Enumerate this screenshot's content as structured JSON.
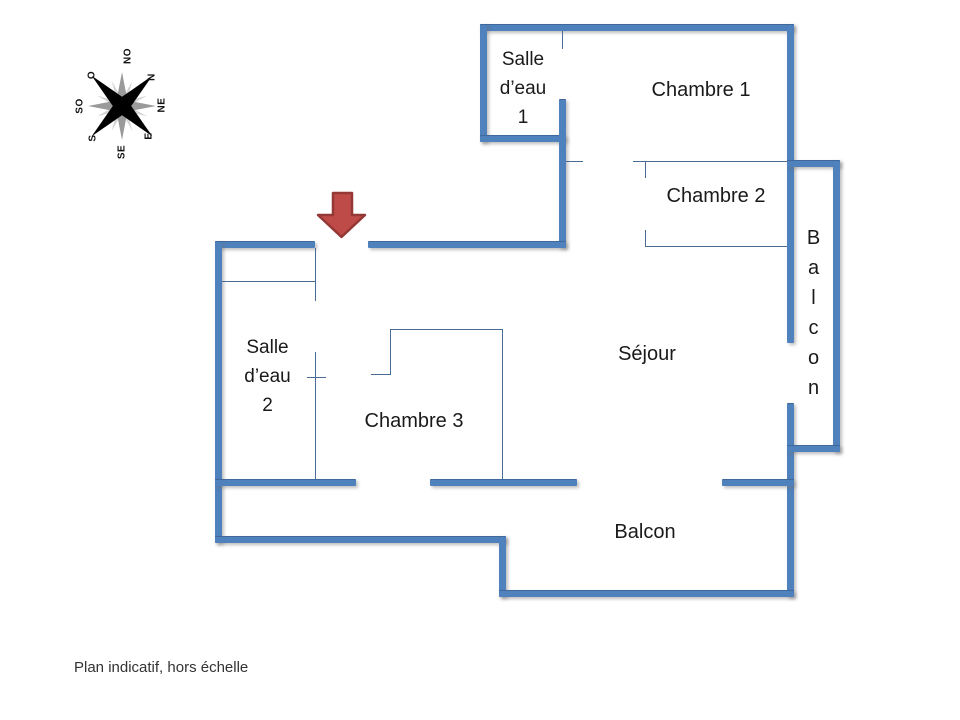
{
  "plan": {
    "rooms": {
      "salle_eau_1": {
        "line1": "Salle",
        "line2": "d’eau",
        "line3": "1"
      },
      "chambre_1": "Chambre 1",
      "chambre_2": "Chambre 2",
      "chambre_3": "Chambre 3",
      "sejour": "Séjour",
      "salle_eau_2": {
        "line1": "Salle",
        "line2": "d’eau",
        "line3": "2"
      },
      "balcon_bottom": "Balcon",
      "balcon_right_letters": [
        "B",
        "a",
        "l",
        "c",
        "o",
        "n"
      ]
    },
    "compass": {
      "labels": [
        "NO",
        "N",
        "NE",
        "E",
        "SE",
        "S",
        "SO",
        "O"
      ]
    },
    "footer_note": "Plan indicatif, hors échelle",
    "colors": {
      "wall": "#4F81BD",
      "thin_line": "#4a6b94",
      "arrow_fill": "#BE4B48",
      "arrow_stroke": "#953735",
      "compass_black": "#000000",
      "compass_gray": "#9a9a9a",
      "compass_light": "#d4d4d4"
    }
  }
}
